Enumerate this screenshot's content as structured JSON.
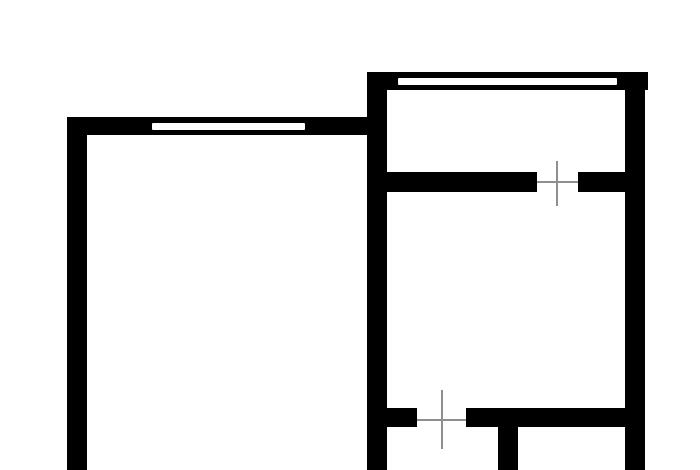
{
  "canvas": {
    "width": 700,
    "height": 470,
    "background": "#ffffff"
  },
  "style": {
    "wall_color": "#000000",
    "window_color": "#ffffff",
    "door_marker_color": "#8f8f8f"
  },
  "floor_plan": {
    "walls": [
      {
        "name": "left-room-left-wall",
        "x": 67,
        "y": 117,
        "w": 20,
        "h": 353
      },
      {
        "name": "left-room-top-wall",
        "x": 67,
        "y": 117,
        "w": 300,
        "h": 18
      },
      {
        "name": "right-unit-top-wall",
        "x": 367,
        "y": 72,
        "w": 281,
        "h": 18
      },
      {
        "name": "right-unit-left-wall",
        "x": 367,
        "y": 72,
        "w": 20,
        "h": 398
      },
      {
        "name": "right-unit-right-wall",
        "x": 625,
        "y": 72,
        "w": 20,
        "h": 398
      },
      {
        "name": "upper-divider-left-segment",
        "x": 387,
        "y": 172,
        "w": 150,
        "h": 20
      },
      {
        "name": "upper-divider-right-segment",
        "x": 578,
        "y": 172,
        "w": 47,
        "h": 20
      },
      {
        "name": "lower-divider-left-stub",
        "x": 387,
        "y": 408,
        "w": 30,
        "h": 19
      },
      {
        "name": "lower-divider-right-segment",
        "x": 466,
        "y": 408,
        "w": 159,
        "h": 19
      },
      {
        "name": "bottom-partition-wall",
        "x": 498,
        "y": 427,
        "w": 20,
        "h": 43
      }
    ],
    "windows": [
      {
        "name": "left-room-window",
        "x": 152,
        "y": 123,
        "w": 153,
        "h": 7
      },
      {
        "name": "right-room-window",
        "x": 398,
        "y": 78,
        "w": 219,
        "h": 7
      }
    ],
    "door_markers": [
      {
        "name": "upper-door-marker-vertical-line",
        "x": 556,
        "y": 161,
        "w": 2,
        "h": 45
      },
      {
        "name": "upper-door-marker-horizontal-line",
        "x": 537,
        "y": 181,
        "w": 41,
        "h": 2
      },
      {
        "name": "lower-door-marker-vertical-line",
        "x": 441,
        "y": 390,
        "w": 2,
        "h": 59
      },
      {
        "name": "lower-door-marker-horizontal-line",
        "x": 417,
        "y": 419,
        "w": 49,
        "h": 2
      }
    ]
  }
}
